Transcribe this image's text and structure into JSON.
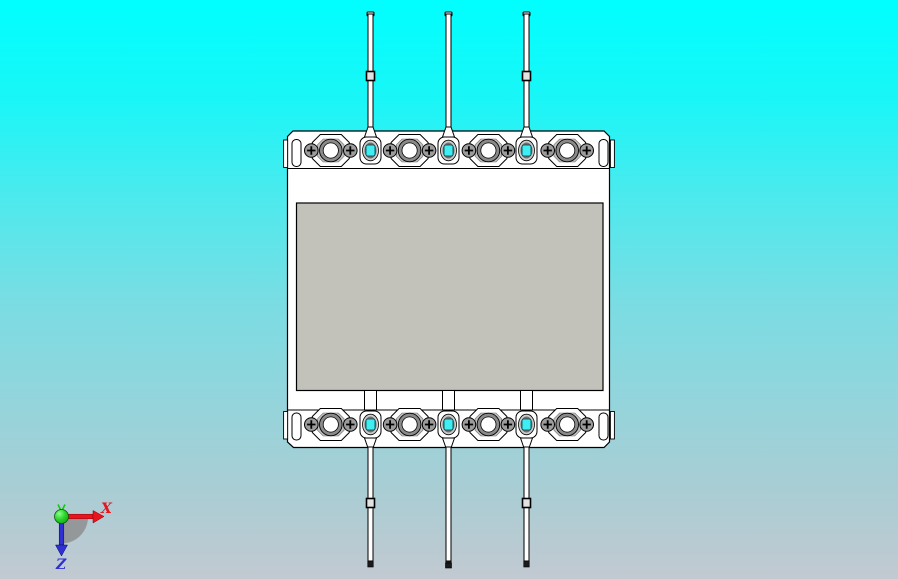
{
  "viewport": {
    "name": "cad-model-viewport",
    "description": "3D CAD preview of a DIN terminal block with wire pins"
  },
  "colors": {
    "bg_top": "#00ffff",
    "bg_mid": "#79dde3",
    "bg_bottom": "#c2c9d1",
    "panel_gray": "#c2c2ba",
    "metal_gray": "#8a8a8a",
    "hole_cyan": "#3feef3",
    "axis_x_red": "#e8141e",
    "axis_z_blue": "#2f2fd3",
    "origin_green": "#18c418"
  },
  "triad": {
    "x_label": "X",
    "z_label": "Z"
  },
  "model": {
    "type": "terminal-block",
    "terminals_top_rail": 4,
    "terminals_bottom_rail": 4,
    "pins_top": 3,
    "pins_bottom": 3
  }
}
